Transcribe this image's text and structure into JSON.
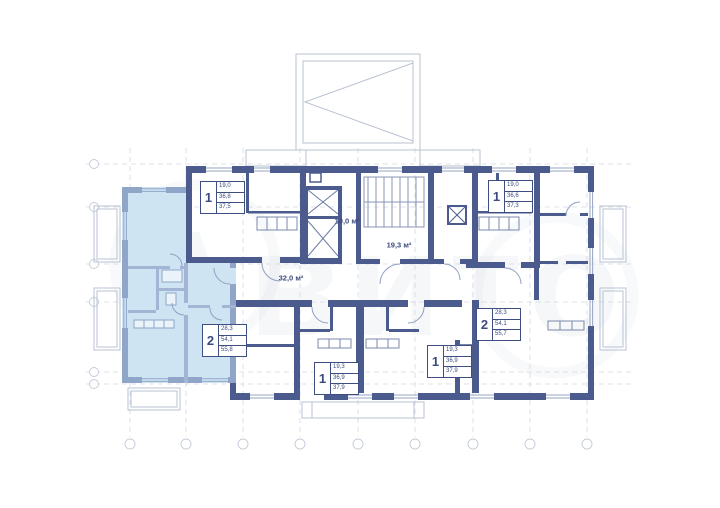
{
  "watermark": {
    "text": "Авито"
  },
  "colors": {
    "wall_dark": "#4c5b8d",
    "wall_light": "#8fa6c9",
    "highlight_fill": "#cfe4f2",
    "grid": "#ccd3df",
    "label_text": "#3b4b7e"
  },
  "apartments": [
    {
      "id": "one-room-top-left",
      "rooms": "1",
      "values": [
        "19,0",
        "36,8",
        "37,5"
      ]
    },
    {
      "id": "one-room-top-right",
      "rooms": "1",
      "values": [
        "19,0",
        "36,6",
        "37,3"
      ]
    },
    {
      "id": "two-room-left-highlighted",
      "rooms": "2",
      "values": [
        "28,3",
        "54,1",
        "55,8"
      ]
    },
    {
      "id": "two-room-right",
      "rooms": "2",
      "values": [
        "28,3",
        "54,1",
        "55,7"
      ]
    },
    {
      "id": "one-room-bottom-left",
      "rooms": "1",
      "values": [
        "19,3",
        "36,9",
        "37,9"
      ]
    },
    {
      "id": "one-room-bottom-right",
      "rooms": "1",
      "values": [
        "19,3",
        "36,9",
        "37,9"
      ]
    }
  ],
  "room_areas": [
    {
      "id": "lift-lobby",
      "text": "10,0 м²"
    },
    {
      "id": "stairwell",
      "text": "19,3 м²"
    },
    {
      "id": "corridor",
      "text": "32,0 м²"
    }
  ]
}
